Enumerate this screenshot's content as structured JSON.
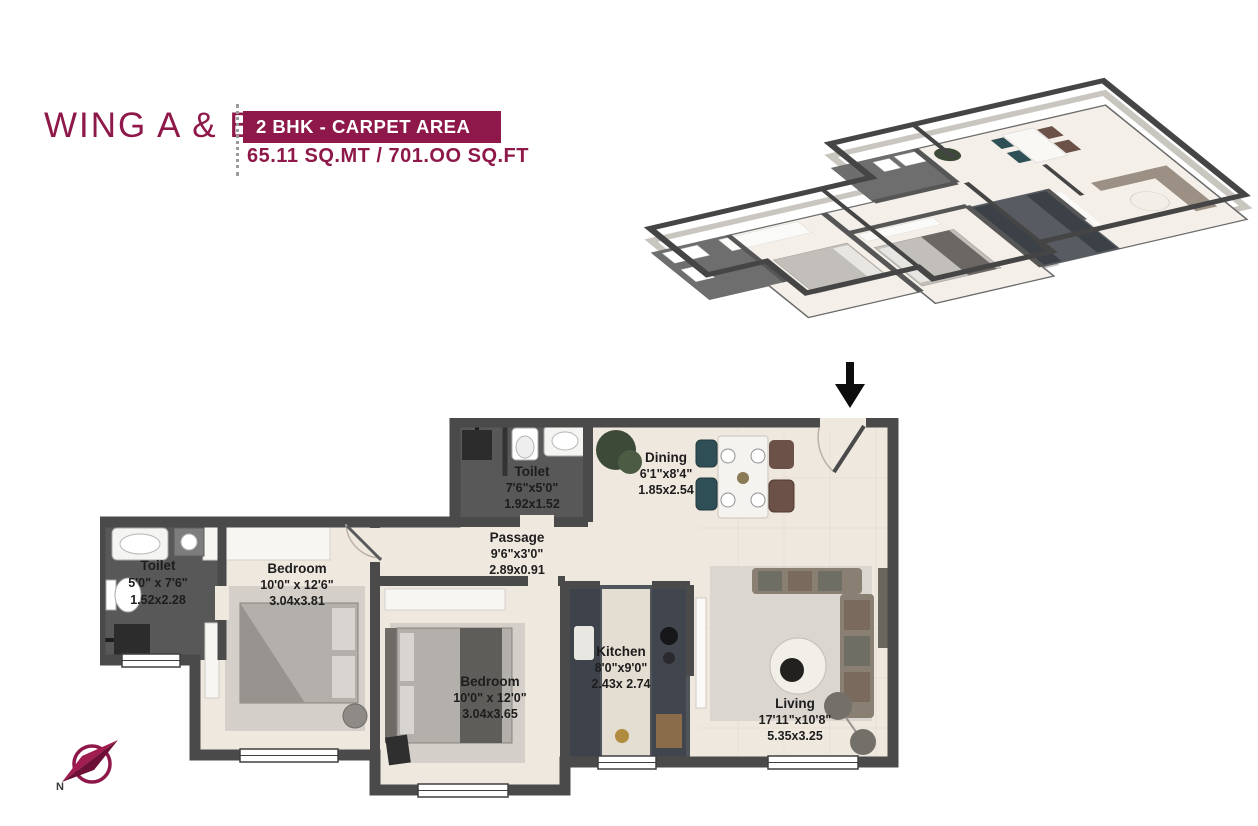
{
  "header": {
    "wing_title": "WING A & B",
    "badge_label": "2 BHK - CARPET AREA",
    "area_text": "65.11 SQ.MT / 701.OO SQ.FT"
  },
  "colors": {
    "accent": "#8E1849",
    "wall": "#4a4a4a",
    "floor": "#efe8df",
    "dark_floor": "#585858"
  },
  "compass": {
    "label": "N"
  },
  "rooms": [
    {
      "id": "toilet-top",
      "name": "Toilet",
      "dim_ft": "7'6\"x5'0\"",
      "dim_m": "1.92x1.52"
    },
    {
      "id": "dining",
      "name": "Dining",
      "dim_ft": "6'1\"x8'4\"",
      "dim_m": "1.85x2.54"
    },
    {
      "id": "passage",
      "name": "Passage",
      "dim_ft": "9'6\"x3'0\"",
      "dim_m": "2.89x0.91"
    },
    {
      "id": "toilet-left",
      "name": "Toilet",
      "dim_ft": "5'0\" x 7'6\"",
      "dim_m": "1.52x2.28"
    },
    {
      "id": "bedroom-1",
      "name": "Bedroom",
      "dim_ft": "10'0\" x 12'6\"",
      "dim_m": "3.04x3.81"
    },
    {
      "id": "bedroom-2",
      "name": "Bedroom",
      "dim_ft": "10'0\" x 12'0\"",
      "dim_m": "3.04x3.65"
    },
    {
      "id": "kitchen",
      "name": "Kitchen",
      "dim_ft": "8'0\"x9'0\"",
      "dim_m": "2.43x 2.74"
    },
    {
      "id": "living",
      "name": "Living",
      "dim_ft": "17'11\"x10'8\"",
      "dim_m": "5.35x3.25"
    }
  ]
}
